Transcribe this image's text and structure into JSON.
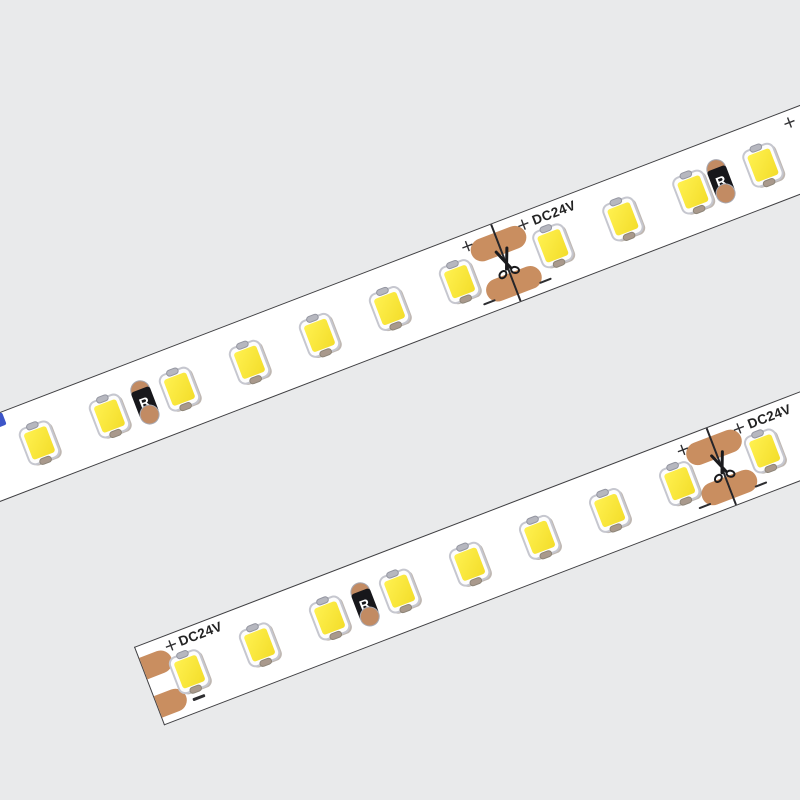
{
  "labels": {
    "voltage": "DC24V",
    "resistor": "R",
    "plus": "+"
  },
  "colors": {
    "background": "#e9eaeb",
    "strip_body": "#ffffff",
    "strip_edge": "#3f3f42",
    "solder_pad": "#c98e60",
    "led_phosphor": "#f6e133",
    "resistor_body": "#17171b",
    "resistor_cap": "#c28b63",
    "marking_text": "#2e2e31",
    "blue_fragment": "#3d55c8"
  },
  "strips": [
    {
      "name": "led-strip-upper",
      "left": -60,
      "top": 435,
      "width": 980,
      "height": 84,
      "angle": -21,
      "left_end": false,
      "leds": [
        90,
        165,
        240,
        315,
        390,
        465,
        540,
        640,
        715,
        790,
        865
      ],
      "resistors": [
        202.5,
        820
      ],
      "cuts": [
        590
      ],
      "extra_plus": [
        905
      ],
      "fragment": true
    },
    {
      "name": "led-strip-lower",
      "left": 134,
      "top": 647,
      "width": 760,
      "height": 84,
      "angle": -21,
      "left_end": true,
      "leds": [
        42,
        117,
        192,
        267,
        342,
        417,
        492,
        567,
        658
      ],
      "resistors": [
        229.5
      ],
      "cuts": [
        612
      ],
      "extra_plus": [],
      "fragment": false
    }
  ]
}
